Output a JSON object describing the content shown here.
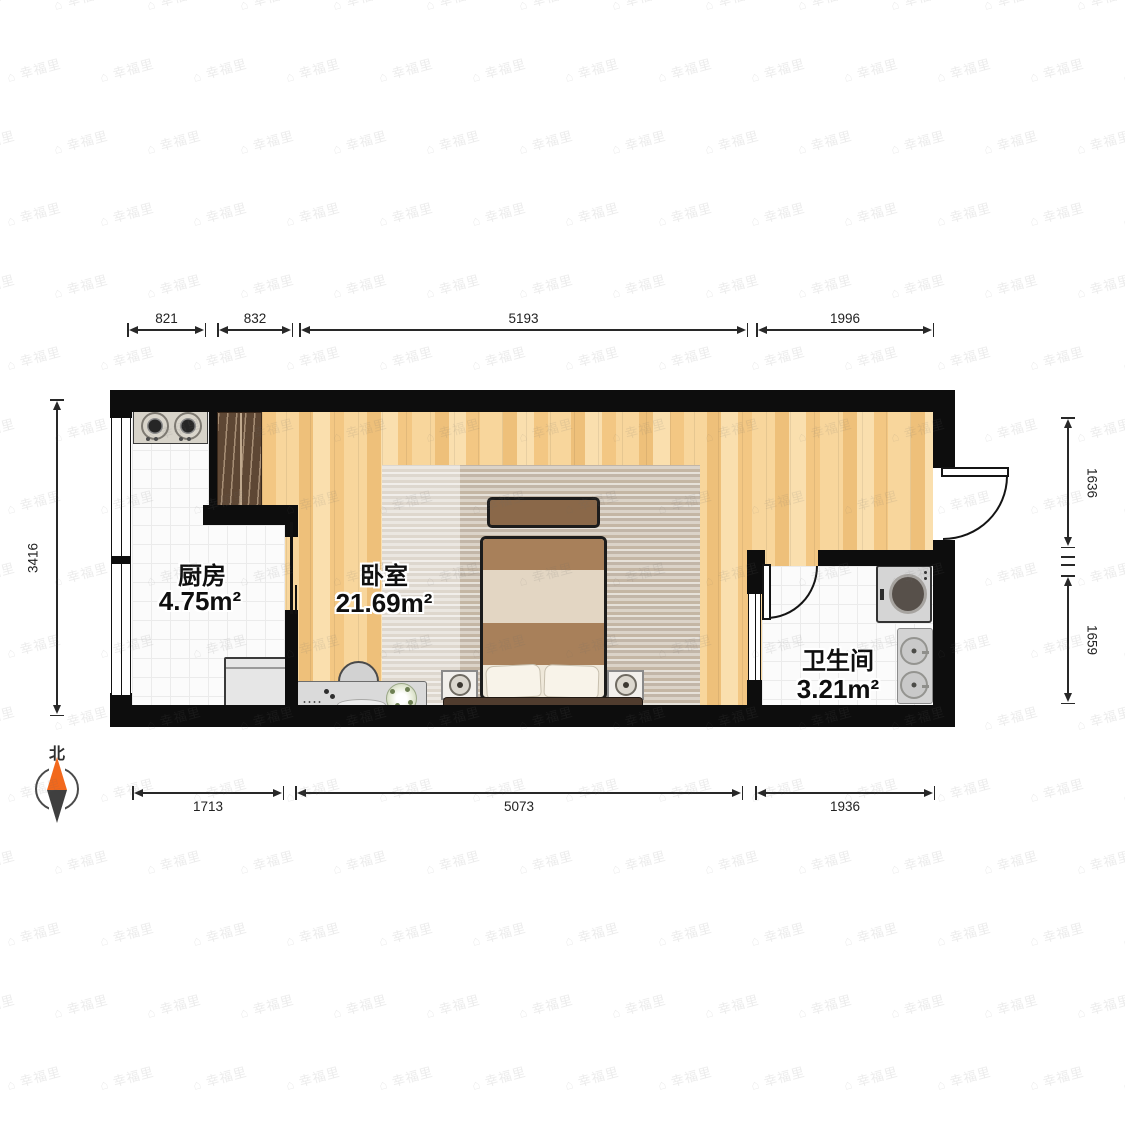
{
  "watermark": {
    "text": "幸福里",
    "logo_glyph": "⌂"
  },
  "compass": {
    "label": "北"
  },
  "rooms": {
    "kitchen": {
      "name": "厨房",
      "area": "4.75m²"
    },
    "bedroom": {
      "name": "卧室",
      "area": "21.69m²"
    },
    "bathroom": {
      "name": "卫生间",
      "area": "3.21m²"
    }
  },
  "dimensions": {
    "top": [
      "821",
      "832",
      "5193",
      "1996"
    ],
    "bottom": [
      "1713",
      "5073",
      "1936"
    ],
    "left": [
      "3416"
    ],
    "right": [
      "1636",
      "1659"
    ]
  }
}
